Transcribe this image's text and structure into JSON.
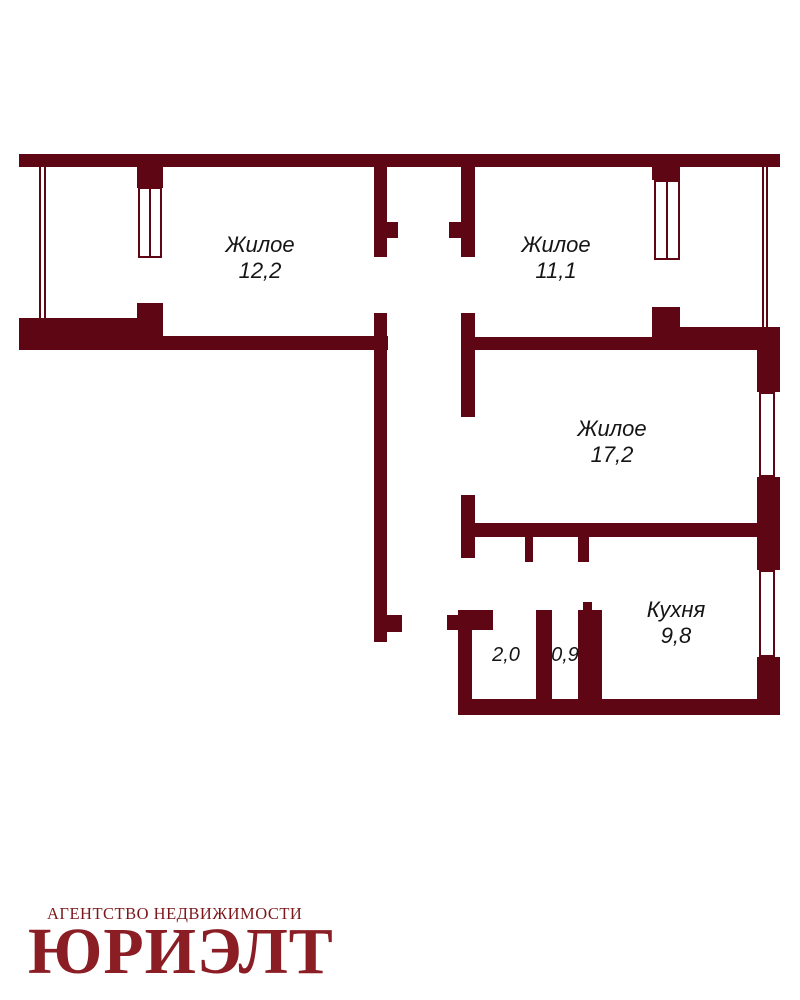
{
  "colors": {
    "wall": "#5e0613",
    "background": "#ffffff",
    "label_text": "#151515",
    "logo_small": "#7b181c",
    "logo_large": "#8b1e24"
  },
  "rooms": [
    {
      "key": "living-room-1",
      "label": "Жилое",
      "area": "12,2",
      "cx": 260,
      "cy": 258,
      "small": false
    },
    {
      "key": "living-room-2",
      "label": "Жилое",
      "area": "11,1",
      "cx": 556,
      "cy": 258,
      "small": false
    },
    {
      "key": "living-room-3",
      "label": "Жилое",
      "area": "17,2",
      "cx": 612,
      "cy": 442,
      "small": false
    },
    {
      "key": "kitchen",
      "label": "Кухня",
      "area": "9,8",
      "cx": 676,
      "cy": 623,
      "small": false
    },
    {
      "key": "bathroom",
      "label": "",
      "area": "2,0",
      "cx": 506,
      "cy": 656,
      "small": true
    },
    {
      "key": "toilet",
      "label": "",
      "area": "0,9",
      "cx": 565,
      "cy": 656,
      "small": true
    }
  ],
  "logo": {
    "agency_line": "АГЕНТСТВО НЕДВИЖИМОСТИ",
    "brand_name": "ЮРИЭЛТ"
  },
  "floorplan": {
    "walls": [
      {
        "x": 19,
        "y": 154,
        "w": 761,
        "h": 13
      },
      {
        "x": 137,
        "y": 167,
        "w": 26,
        "h": 21
      },
      {
        "x": 137,
        "y": 303,
        "w": 26,
        "h": 15
      },
      {
        "x": 19,
        "y": 318,
        "w": 144,
        "h": 32
      },
      {
        "x": 162,
        "y": 336,
        "w": 226,
        "h": 14
      },
      {
        "x": 374,
        "y": 167,
        "w": 13,
        "h": 90
      },
      {
        "x": 387,
        "y": 222,
        "w": 11,
        "h": 16
      },
      {
        "x": 374,
        "y": 313,
        "w": 13,
        "h": 329
      },
      {
        "x": 387,
        "y": 615,
        "w": 15,
        "h": 17
      },
      {
        "x": 461,
        "y": 167,
        "w": 14,
        "h": 90
      },
      {
        "x": 449,
        "y": 222,
        "w": 12,
        "h": 16
      },
      {
        "x": 461,
        "y": 313,
        "w": 14,
        "h": 104
      },
      {
        "x": 461,
        "y": 495,
        "w": 14,
        "h": 63
      },
      {
        "x": 652,
        "y": 167,
        "w": 28,
        "h": 13
      },
      {
        "x": 652,
        "y": 307,
        "w": 28,
        "h": 43
      },
      {
        "x": 475,
        "y": 337,
        "w": 177,
        "h": 13
      },
      {
        "x": 680,
        "y": 327,
        "w": 100,
        "h": 23
      },
      {
        "x": 757,
        "y": 350,
        "w": 23,
        "h": 42
      },
      {
        "x": 757,
        "y": 477,
        "w": 23,
        "h": 93
      },
      {
        "x": 757,
        "y": 657,
        "w": 23,
        "h": 58
      },
      {
        "x": 473,
        "y": 523,
        "w": 285,
        "h": 14
      },
      {
        "x": 525,
        "y": 537,
        "w": 8,
        "h": 25
      },
      {
        "x": 578,
        "y": 537,
        "w": 11,
        "h": 25
      },
      {
        "x": 458,
        "y": 610,
        "w": 35,
        "h": 20
      },
      {
        "x": 458,
        "y": 630,
        "w": 14,
        "h": 85
      },
      {
        "x": 536,
        "y": 610,
        "w": 16,
        "h": 105
      },
      {
        "x": 578,
        "y": 610,
        "w": 24,
        "h": 105
      },
      {
        "x": 583,
        "y": 602,
        "w": 9,
        "h": 8
      },
      {
        "x": 447,
        "y": 615,
        "w": 11,
        "h": 15
      },
      {
        "x": 458,
        "y": 699,
        "w": 322,
        "h": 16
      }
    ],
    "windows": [
      {
        "x": 138,
        "y": 187,
        "w": 24,
        "h": 71,
        "mullion": true
      },
      {
        "x": 654,
        "y": 180,
        "w": 26,
        "h": 80,
        "mullion": true
      },
      {
        "x": 759,
        "y": 392,
        "w": 16,
        "h": 85,
        "mullion": false
      },
      {
        "x": 759,
        "y": 570,
        "w": 16,
        "h": 87,
        "mullion": false
      }
    ],
    "glazing_lines": [
      {
        "x": 39,
        "y": 167,
        "w": 2,
        "h": 151
      },
      {
        "x": 44,
        "y": 167,
        "w": 2,
        "h": 151
      },
      {
        "x": 762,
        "y": 167,
        "w": 2,
        "h": 160
      },
      {
        "x": 766,
        "y": 167,
        "w": 2,
        "h": 160
      }
    ]
  }
}
